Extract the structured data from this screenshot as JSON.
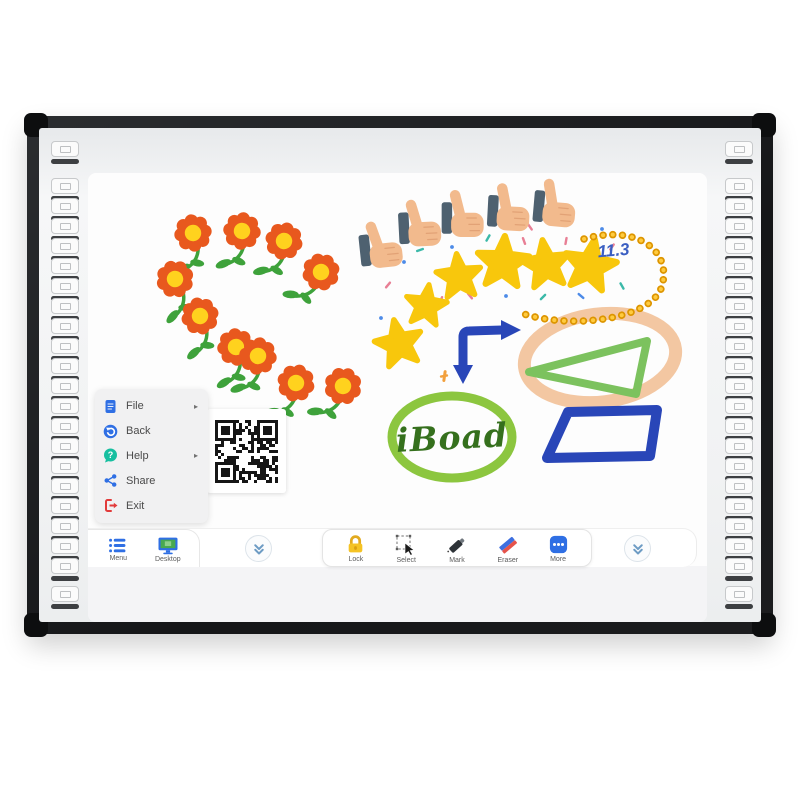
{
  "product": {
    "name": "Interactive Whiteboard"
  },
  "context_menu": {
    "submenu_arrow": "▸",
    "items": [
      {
        "label": "File",
        "icon": "file-icon",
        "has_submenu": true
      },
      {
        "label": "Back",
        "icon": "back-icon",
        "has_submenu": false
      },
      {
        "label": "Help",
        "icon": "help-icon",
        "has_submenu": true
      },
      {
        "label": "Share",
        "icon": "share-icon",
        "has_submenu": false
      },
      {
        "label": "Exit",
        "icon": "exit-icon",
        "has_submenu": false
      }
    ]
  },
  "taskbar": {
    "items": [
      {
        "label": "Menu",
        "icon": "menu-list-icon"
      },
      {
        "label": "Desktop",
        "icon": "desktop-monitor-icon"
      }
    ]
  },
  "toolbar": {
    "items": [
      {
        "label": "Lock",
        "icon": "lock-icon"
      },
      {
        "label": "Select",
        "icon": "select-icon"
      },
      {
        "label": "Mark",
        "icon": "marker-icon"
      },
      {
        "label": "Eraser",
        "icon": "eraser-icon"
      },
      {
        "label": "More",
        "icon": "more-icon"
      }
    ]
  },
  "collapse": {
    "icon": "double-chevron-down-icon",
    "count": 2
  },
  "hotkey_strips": {
    "left_count": 22,
    "right_count": 22
  },
  "ui_colors": {
    "accent": "#2F6FE4",
    "help": "#17BFA0",
    "exit": "#E23B3B",
    "lock": "#F5C324",
    "marker": "#2E3338",
    "eraserblue": "#3D6FE0",
    "eraserred": "#E5534B",
    "chevron": "#6E9CC4",
    "desktopgreen": "#49A94F"
  },
  "drawing": {
    "texts": {
      "board_handwriting": "iBoad",
      "number": "11.3"
    },
    "colors": {
      "petal": "#E8581E",
      "center": "#FFD21E",
      "leaf": "#3EA23B",
      "star": "#F8C70C",
      "skin": "#F2BA8D",
      "sleeve": "#4E6170",
      "bead": "#DD9500",
      "beadhi": "#FFCB3F",
      "inkblue": "#2946B8",
      "inkgreen": "#8CC63F",
      "dgreen": "#35701D",
      "peach": "#F3C7A2",
      "trigreen": "#7CC25E",
      "handblue": "#3A5EC2",
      "confdash": "#F2A03D"
    },
    "flowers": [
      [
        193,
        233,
        -8
      ],
      [
        242,
        231,
        6
      ],
      [
        284,
        241,
        14
      ],
      [
        321,
        272,
        30
      ],
      [
        175,
        279,
        -20
      ],
      [
        200,
        316,
        -14
      ],
      [
        236,
        347,
        -5
      ],
      [
        258,
        356,
        8
      ],
      [
        296,
        383,
        16
      ],
      [
        343,
        386,
        24
      ]
    ],
    "thumbs": [
      [
        388,
        247,
        -6
      ],
      [
        427,
        226,
        -3
      ],
      [
        470,
        217,
        0
      ],
      [
        516,
        211,
        3
      ],
      [
        562,
        207,
        5
      ]
    ],
    "stars": [
      [
        399,
        344,
        0.82,
        -12
      ],
      [
        426,
        306,
        0.72,
        8
      ],
      [
        459,
        277,
        0.78,
        -6
      ],
      [
        503,
        263,
        0.9,
        4
      ],
      [
        546,
        265,
        0.84,
        -8
      ],
      [
        590,
        266,
        0.9,
        10
      ]
    ],
    "confetti_colors": [
      "#E87F95",
      "#4D8BE8",
      "#3BB9A9",
      "#F2A03D"
    ],
    "confetti": [
      [
        388,
        285,
        40,
        0,
        0
      ],
      [
        404,
        262,
        -30,
        1,
        1
      ],
      [
        420,
        250,
        70,
        2,
        0
      ],
      [
        441,
        300,
        20,
        0,
        0
      ],
      [
        452,
        247,
        0,
        1,
        1
      ],
      [
        470,
        296,
        -40,
        0,
        0
      ],
      [
        488,
        238,
        30,
        2,
        0
      ],
      [
        506,
        296,
        60,
        1,
        1
      ],
      [
        524,
        241,
        -20,
        0,
        0
      ],
      [
        543,
        297,
        45,
        2,
        0
      ],
      [
        566,
        241,
        10,
        0,
        0
      ],
      [
        581,
        296,
        -50,
        1,
        0
      ],
      [
        612,
        247,
        35,
        0,
        0
      ],
      [
        622,
        286,
        -30,
        2,
        0
      ],
      [
        381,
        318,
        60,
        1,
        1
      ],
      [
        414,
        334,
        -45,
        2,
        0
      ],
      [
        444,
        376,
        80,
        3,
        0
      ],
      [
        455,
        222,
        20,
        3,
        0
      ],
      [
        530,
        227,
        -35,
        0,
        0
      ],
      [
        602,
        229,
        50,
        1,
        1
      ]
    ]
  }
}
